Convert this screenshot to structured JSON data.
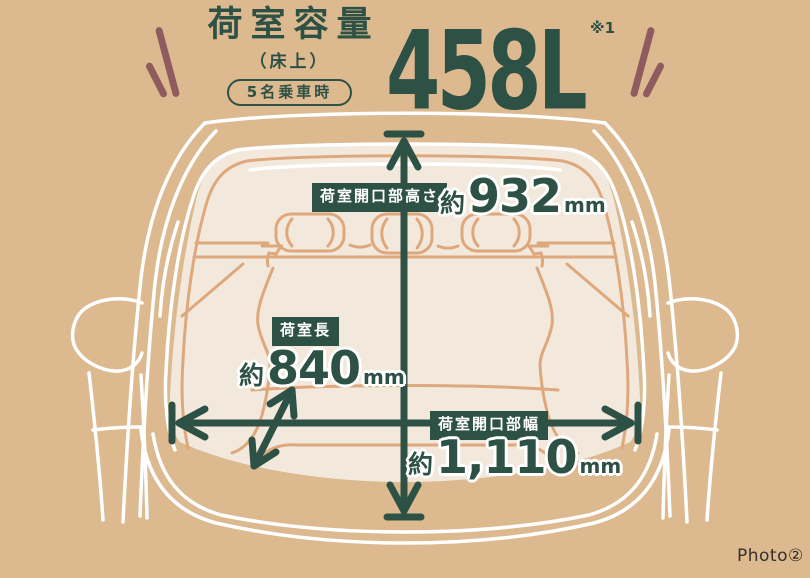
{
  "header": {
    "title": "荷室容量",
    "subtitle": "（床上）",
    "condition": "5名乗車時",
    "capacity": "458L",
    "footnote_mark": "※1"
  },
  "dimensions": {
    "opening_height": {
      "label": "荷室開口部高さ",
      "approx": "約",
      "value": "932",
      "unit": "mm"
    },
    "cargo_length": {
      "label": "荷室長",
      "approx": "約",
      "value": "840",
      "unit": "mm"
    },
    "opening_width": {
      "label": "荷室開口部幅",
      "approx": "約",
      "value": "1,110",
      "unit": "mm"
    }
  },
  "footer": {
    "photo_label": "Photo②"
  },
  "colors": {
    "background": "#dcb98f",
    "ink_green": "#2e5145",
    "cream": "#f2e9dc",
    "line_tan": "#dfa87c",
    "accent_maroon": "#8f5b5e",
    "white": "#ffffff",
    "footer_ink": "#35302b"
  }
}
